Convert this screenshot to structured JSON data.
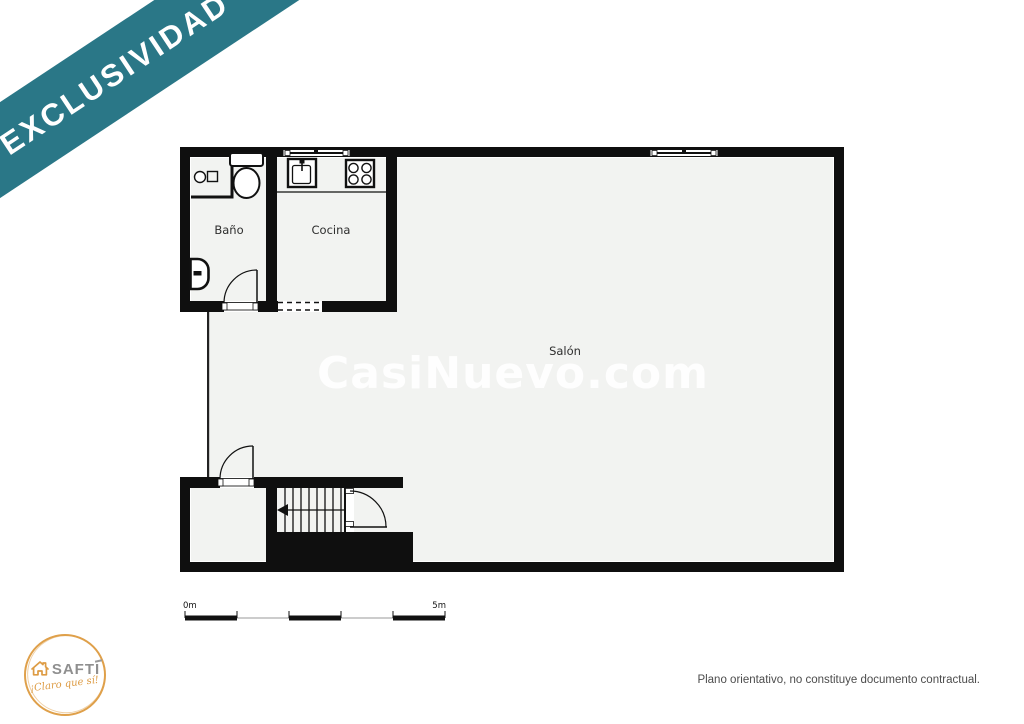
{
  "banner": {
    "label": "EXCLUSIVIDAD",
    "color": "#2a7787"
  },
  "watermark": {
    "text": "CasiNuevo.com"
  },
  "floorplan": {
    "rooms": [
      {
        "name": "Baño"
      },
      {
        "name": "Cocina"
      },
      {
        "name": "Salón"
      }
    ],
    "icons": [
      "washbasin-icon",
      "toilet-icon",
      "bidet-icon",
      "kitchen-sink-icon",
      "stove-icon",
      "stairs-icon",
      "door-arc-icon",
      "window-icon"
    ],
    "wall_color": "#0f0f0f",
    "floor_color": "#f2f3f1"
  },
  "scale_bar": {
    "start_label": "0m",
    "end_label": "5m"
  },
  "footer": {
    "brand": "SAFTI",
    "tagline": "¡Claro que sí!",
    "disclaimer": "Plano orientativo, no constituye documento contractual.",
    "brand_color": "#dd9b43"
  }
}
